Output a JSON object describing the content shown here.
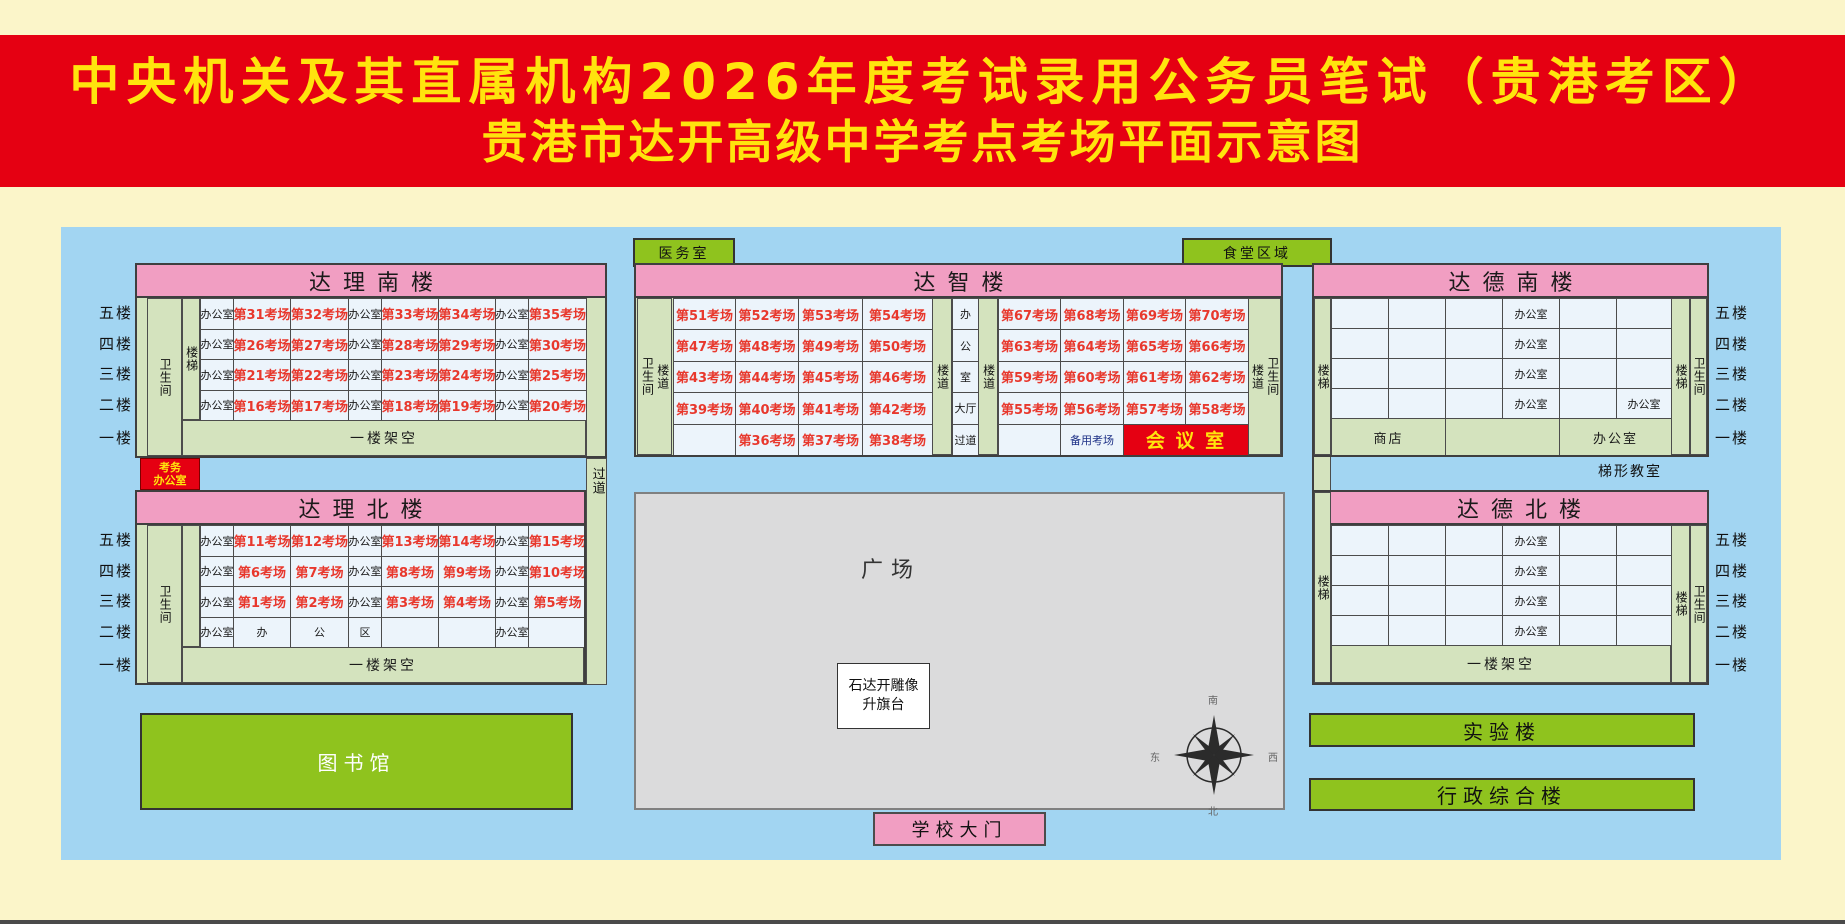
{
  "banner": {
    "line1": "中央机关及其直属机构2026年度考试录用公务员笔试（贵港考区）",
    "line2": "贵港市达开高级中学考点考场平面示意图"
  },
  "floor_labels": [
    "五楼",
    "四楼",
    "三楼",
    "二楼",
    "一楼"
  ],
  "corridor_label": "过道",
  "exam_office": {
    "line1": "考务",
    "line2": "办公室"
  },
  "dali_south": {
    "title": "达理南楼",
    "restroom": "卫生间",
    "stair": "楼梯",
    "ground_floor": "一楼架空",
    "rows": [
      [
        "办公室",
        "第31考场",
        "第32考场",
        "办公室",
        "第33考场",
        "第34考场",
        "办公室",
        "第35考场"
      ],
      [
        "办公室",
        "第26考场",
        "第27考场",
        "办公室",
        "第28考场",
        "第29考场",
        "办公室",
        "第30考场"
      ],
      [
        "办公室",
        "第21考场",
        "第22考场",
        "办公室",
        "第23考场",
        "第24考场",
        "办公室",
        "第25考场"
      ],
      [
        "办公室",
        "第16考场",
        "第17考场",
        "办公室",
        "第18考场",
        "第19考场",
        "办公室",
        "第20考场"
      ]
    ]
  },
  "dali_north": {
    "title": "达理北楼",
    "restroom": "卫生间",
    "ground_floor": "一楼架空",
    "rows": [
      [
        "办公室",
        "第11考场",
        "第12考场",
        "办公室",
        "第13考场",
        "第14考场",
        "办公室",
        "第15考场"
      ],
      [
        "办公室",
        "第6考场",
        "第7考场",
        "办公室",
        "第8考场",
        "第9考场",
        "办公室",
        "第10考场"
      ],
      [
        "办公室",
        "第1考场",
        "第2考场",
        "办公室",
        "第3考场",
        "第4考场",
        "办公室",
        "第5考场"
      ],
      [
        "办公室",
        "办",
        "公",
        "区",
        "",
        "",
        "办公室",
        ""
      ]
    ]
  },
  "dazhi": {
    "title": "达智楼",
    "medical": "医务室",
    "canteen": "食堂区域",
    "left_restroom": "卫生间",
    "left_hallway": "楼道",
    "hallway1": "楼道",
    "hallway2": "楼道",
    "right_hallway": "楼道",
    "right_restroom": "卫生间",
    "left_rows": [
      [
        "第51考场",
        "第52考场",
        "第53考场",
        "第54考场"
      ],
      [
        "第47考场",
        "第48考场",
        "第49考场",
        "第50考场"
      ],
      [
        "第43考场",
        "第44考场",
        "第45考场",
        "第46考场"
      ],
      [
        "第39考场",
        "第40考场",
        "第41考场",
        "第42考场"
      ],
      [
        "",
        "第36考场",
        "第37考场",
        "第38考场"
      ]
    ],
    "center_rows": [
      [
        "办"
      ],
      [
        "公"
      ],
      [
        "室"
      ],
      [
        "大厅"
      ],
      [
        "过道"
      ]
    ],
    "right_rows": [
      [
        "第67考场",
        "第68考场",
        "第69考场",
        "第70考场"
      ],
      [
        "第63考场",
        "第64考场",
        "第65考场",
        "第66考场"
      ],
      [
        "第59考场",
        "第60考场",
        "第61考场",
        "第62考场"
      ],
      [
        "第55考场",
        "第56考场",
        "第57考场",
        "第58考场"
      ],
      [
        "",
        {
          "t": "备用考场",
          "cls": "spare"
        },
        {
          "t": "会 议 室",
          "cls": "meeting",
          "span": 2
        }
      ]
    ]
  },
  "dade_south": {
    "title": "达德南楼",
    "stair": "楼梯",
    "stair_right": "楼梯",
    "restroom": "卫生间",
    "rows": [
      [
        "",
        "",
        "",
        "办公室",
        "",
        ""
      ],
      [
        "",
        "",
        "",
        "办公室",
        "",
        ""
      ],
      [
        "",
        "",
        "",
        "办公室",
        "",
        ""
      ],
      [
        "",
        "",
        "",
        "办公室",
        "",
        "办公室"
      ]
    ],
    "ground_row": [
      [
        {
          "t": "商店",
          "span": 2
        },
        {
          "t": "",
          "span": 2
        },
        {
          "t": "办公室",
          "span": 2
        }
      ]
    ]
  },
  "dade_north": {
    "title": "达德北楼",
    "stair": "楼梯",
    "stair_right": "楼梯",
    "restroom": "卫生间",
    "ground_floor": "一楼架空",
    "rows": [
      [
        "",
        "",
        "",
        "办公室",
        "",
        ""
      ],
      [
        "",
        "",
        "",
        "办公室",
        "",
        ""
      ],
      [
        "",
        "",
        "",
        "办公室",
        "",
        ""
      ],
      [
        "",
        "",
        "",
        "办公室",
        "",
        ""
      ]
    ]
  },
  "trapezoid_classroom": "梯形教室",
  "library": "图书馆",
  "plaza": "广场",
  "statue": {
    "line1": "石达开雕像",
    "line2": "升旗台"
  },
  "gate": "学校大门",
  "lab": "实验楼",
  "admin": "行政综合楼",
  "compass": {
    "top": "南",
    "bottom": "北",
    "left": "东",
    "right": "西"
  },
  "colors": {
    "banner_red": "#E50012",
    "banner_yellow": "#FFE40D",
    "map_blue": "#A2D5F2",
    "building_green": "#D4E3BE",
    "header_pink": "#F19EC2",
    "cell_blue": "#ECF4FB",
    "exam_red": "#E8382D",
    "spare_navy": "#1D3086",
    "bright_green": "#8FC31E",
    "plaza_gray": "#DBDBDC",
    "background_cream": "#FBF5C9"
  }
}
